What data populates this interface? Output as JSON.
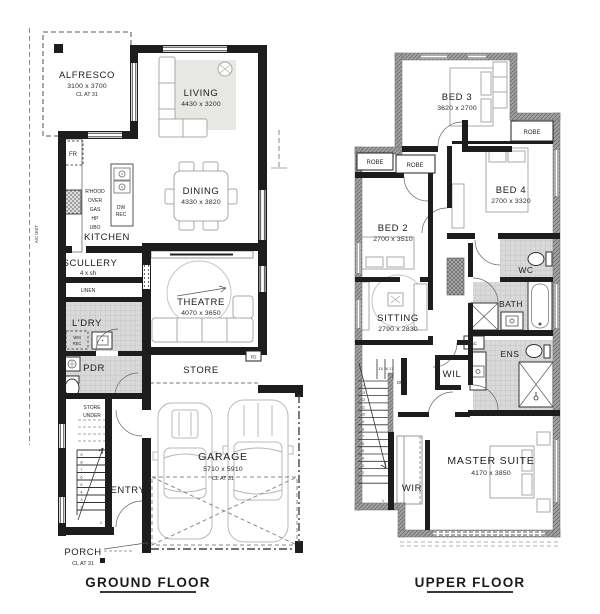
{
  "ground": {
    "title": "GROUND FLOOR",
    "alfresco_name": "ALFRESCO",
    "alfresco_dims": "3100 x 3700",
    "alfresco_note": "CL AT 31",
    "living_name": "LIVING",
    "living_dims": "4430 x 3200",
    "dining_name": "DINING",
    "dining_dims": "4330 x 3820",
    "kitchen_name": "KITCHEN",
    "fr_label": "FR",
    "rhood_lines": [
      "R'HOOD",
      "OVER",
      "GAS",
      "HP",
      "UBO"
    ],
    "dw_lines": [
      "DW",
      "REC"
    ],
    "ac_unit_label": "A/C UNIT",
    "scullery_name": "SCULLERY",
    "scullery_note": "4 x sh",
    "linen_label": "LINEN",
    "ldry_name": "L'DRY",
    "wm_lines": [
      "WM",
      "REC"
    ],
    "pdr_name": "PDR",
    "theatre_name": "THEATRE",
    "theatre_dims": "4070 x 3650",
    "store_name": "STORE",
    "pd_label": "PD",
    "store_under_lines": [
      "STORE",
      "UNDER"
    ],
    "entry_name": "ENTRY",
    "garage_name": "GARAGE",
    "garage_dims": "5710 x 5910",
    "garage_note": "CL AT 31",
    "porch_name": "PORCH",
    "porch_note": "CL AT 31",
    "stair_numbers": [
      "9",
      "8",
      "7",
      "6",
      "5",
      "4",
      "3",
      "2"
    ],
    "stair_first": "1"
  },
  "upper": {
    "title": "UPPER FLOOR",
    "bed3_name": "BED 3",
    "bed3_dims": "3620 x 2700",
    "bed4_name": "BED 4",
    "bed4_dims": "2700 x 3320",
    "bed2_name": "BED 2",
    "bed2_dims": "2700 x 3510",
    "sitting_name": "SITTING",
    "sitting_dims": "2790 x 2830",
    "master_name": "MASTER SUITE",
    "master_dims": "4170 x 3850",
    "wc_label": "WC",
    "bath_label": "BATH",
    "ens_label": "ENS",
    "wil_label": "WIL",
    "wir_label": "WIR",
    "robe_labels": [
      "ROBE",
      "ROBE",
      "ROBE"
    ],
    "ac_label": "AC",
    "stair_top_numbers": "15 16 17",
    "dn_label": "DN",
    "stair_numbers": [
      "14",
      "13",
      "12",
      "11",
      "10",
      "9",
      "8",
      "7",
      "6",
      "5",
      "4",
      "3",
      "2"
    ],
    "stair_first": "1"
  },
  "colors": {
    "wall_black": "#1d1d1d",
    "upper_wall_gray": "#a3a3a3",
    "tile_gray": "#d9d9d9"
  }
}
